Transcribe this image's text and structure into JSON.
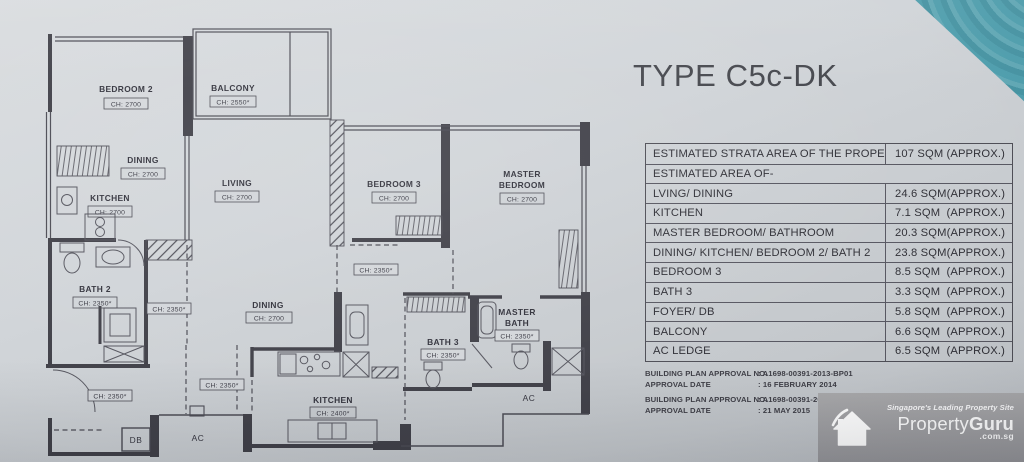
{
  "title": "TYPE C5c-DK",
  "area_table": {
    "strata_row": {
      "label": "ESTIMATED STRATA AREA OF THE PROPERTY",
      "value": "107 SQM",
      "approx": "(APPROX.)"
    },
    "section_label": "ESTIMATED AREA OF-",
    "rows": [
      {
        "label": "LVING/ DINING",
        "value": "24.6 SQM",
        "approx": "(APPROX.)"
      },
      {
        "label": "KITCHEN",
        "value": "7.1 SQM",
        "approx": "(APPROX.)"
      },
      {
        "label": "MASTER BEDROOM/ BATHROOM",
        "value": "20.3 SQM",
        "approx": "(APPROX.)"
      },
      {
        "label": "DINING/ KITCHEN/ BEDROOM 2/ BATH 2",
        "value": "23.8 SQM",
        "approx": "(APPROX.)"
      },
      {
        "label": "BEDROOM  3",
        "value": "8.5 SQM",
        "approx": "(APPROX.)"
      },
      {
        "label": "BATH 3",
        "value": "3.3 SQM",
        "approx": "(APPROX.)"
      },
      {
        "label": "FOYER/ DB",
        "value": "5.8 SQM",
        "approx": "(APPROX.)"
      },
      {
        "label": "BALCONY",
        "value": "6.6 SQM",
        "approx": "(APPROX.)"
      },
      {
        "label": "AC LEDGE",
        "value": "6.5 SQM",
        "approx": "(APPROX.)"
      }
    ]
  },
  "approvals": [
    {
      "label": "BUILDING  PLAN APPROVAL NO.",
      "value": ":  A1698-00391-2013-BP01"
    },
    {
      "label": "APPROVAL DATE",
      "value": ":  16 FEBRUARY 2014"
    },
    {
      "label": "BUILDING  PLAN APPROVAL NO.",
      "value": ":  A1698-00391-2013-BP02"
    },
    {
      "label": "APPROVAL DATE",
      "value": ":  21 MAY 2015"
    }
  ],
  "watermark": {
    "tagline": "Singapore's Leading Property Site",
    "brand_left": "Property",
    "brand_right": "Guru",
    "domain": ".com.sg"
  },
  "floorplan": {
    "bedroom2": {
      "name": "BEDROOM 2",
      "ch": "CH: 2700"
    },
    "balcony": {
      "name": "BALCONY",
      "ch": "CH: 2550*"
    },
    "dining_upper": {
      "name": "DINING",
      "ch": "CH: 2700"
    },
    "kitchen_upper": {
      "name": "KITCHEN",
      "ch": "CH: 2700"
    },
    "living": {
      "name": "LIVING",
      "ch": "CH: 2700"
    },
    "bedroom3": {
      "name": "BEDROOM 3",
      "ch": "CH: 2700"
    },
    "master_bedroom": {
      "line1": "MASTER",
      "line2": "BEDROOM",
      "ch": "CH: 2700"
    },
    "bath2": {
      "name": "BATH 2",
      "ch": "CH: 2350*"
    },
    "dining_lower": {
      "name": "DINING",
      "ch": "CH: 2700"
    },
    "bath3": {
      "name": "BATH 3",
      "ch": "CH: 2350*"
    },
    "master_bath": {
      "line1": "MASTER",
      "line2": "BATH",
      "ch": "CH: 2350*"
    },
    "kitchen_lower": {
      "name": "KITCHEN",
      "ch": "CH: 2400*"
    },
    "ch_hallway": "CH: 2350*",
    "ch_below_bedroom3": "CH: 2350*",
    "ch_foyer_mid": "CH: 2350*",
    "ch_foyer": "CH: 2350*",
    "db": "DB",
    "ac_bottom": "AC",
    "ac_right": "AC"
  },
  "colors": {
    "paper": "#cfd3d7",
    "teal_corner": "#4e9dac",
    "plan_line": "#3f3f47",
    "watermark_bg": "#9d9da0",
    "text": "#2e2e35"
  }
}
